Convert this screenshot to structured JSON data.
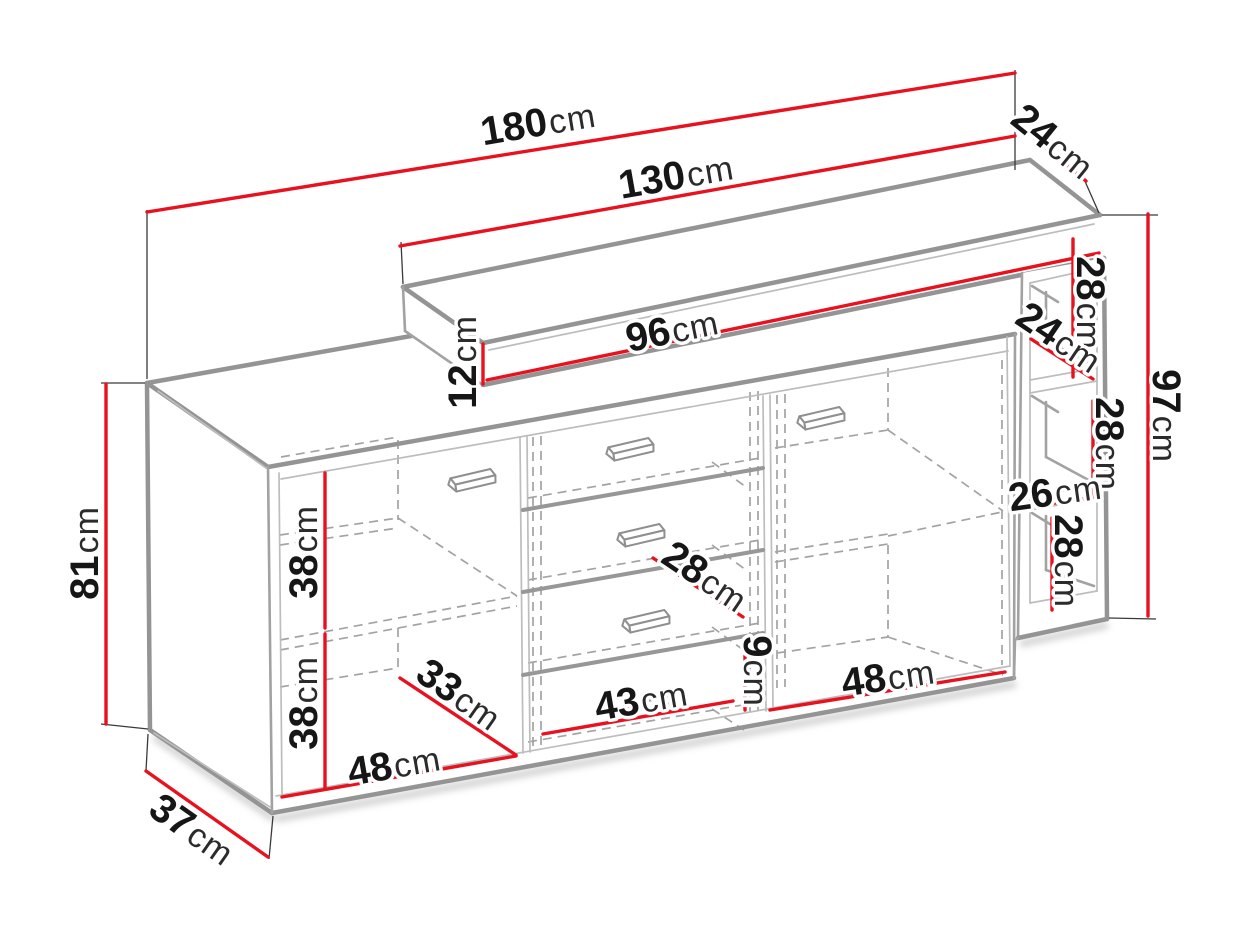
{
  "diagram": {
    "title": "Sideboard dimension diagram",
    "unit": "cm",
    "colors": {
      "dimension_line": "#e8121f",
      "outline_gray": "#949494",
      "text": "#161616",
      "background": "#ffffff"
    },
    "dimensions": [
      {
        "id": "total-width",
        "value": "180",
        "unit": "cm"
      },
      {
        "id": "top-shelf-depth",
        "value": "24",
        "unit": "cm"
      },
      {
        "id": "upper-section-width",
        "value": "130",
        "unit": "cm"
      },
      {
        "id": "upper-shelf-inner-width",
        "value": "96",
        "unit": "cm"
      },
      {
        "id": "upper-shelf-height",
        "value": "12",
        "unit": "cm"
      },
      {
        "id": "side-opening-1-height",
        "value": "28",
        "unit": "cm"
      },
      {
        "id": "side-opening-depth",
        "value": "24",
        "unit": "cm"
      },
      {
        "id": "right-section-height",
        "value": "97",
        "unit": "cm"
      },
      {
        "id": "side-opening-2-height",
        "value": "28",
        "unit": "cm"
      },
      {
        "id": "side-opening-width",
        "value": "26",
        "unit": "cm"
      },
      {
        "id": "side-opening-3-height",
        "value": "28",
        "unit": "cm"
      },
      {
        "id": "body-height",
        "value": "81",
        "unit": "cm"
      },
      {
        "id": "left-compartment-upper-height",
        "value": "38",
        "unit": "cm"
      },
      {
        "id": "left-compartment-lower-height",
        "value": "38",
        "unit": "cm"
      },
      {
        "id": "left-compartment-depth",
        "value": "33",
        "unit": "cm"
      },
      {
        "id": "left-compartment-width",
        "value": "48",
        "unit": "cm"
      },
      {
        "id": "body-depth",
        "value": "37",
        "unit": "cm"
      },
      {
        "id": "drawer-width",
        "value": "43",
        "unit": "cm"
      },
      {
        "id": "drawer-depth",
        "value": "28",
        "unit": "cm"
      },
      {
        "id": "plinth-height",
        "value": "9",
        "unit": "cm"
      },
      {
        "id": "right-compartment-width",
        "value": "48",
        "unit": "cm"
      }
    ]
  }
}
